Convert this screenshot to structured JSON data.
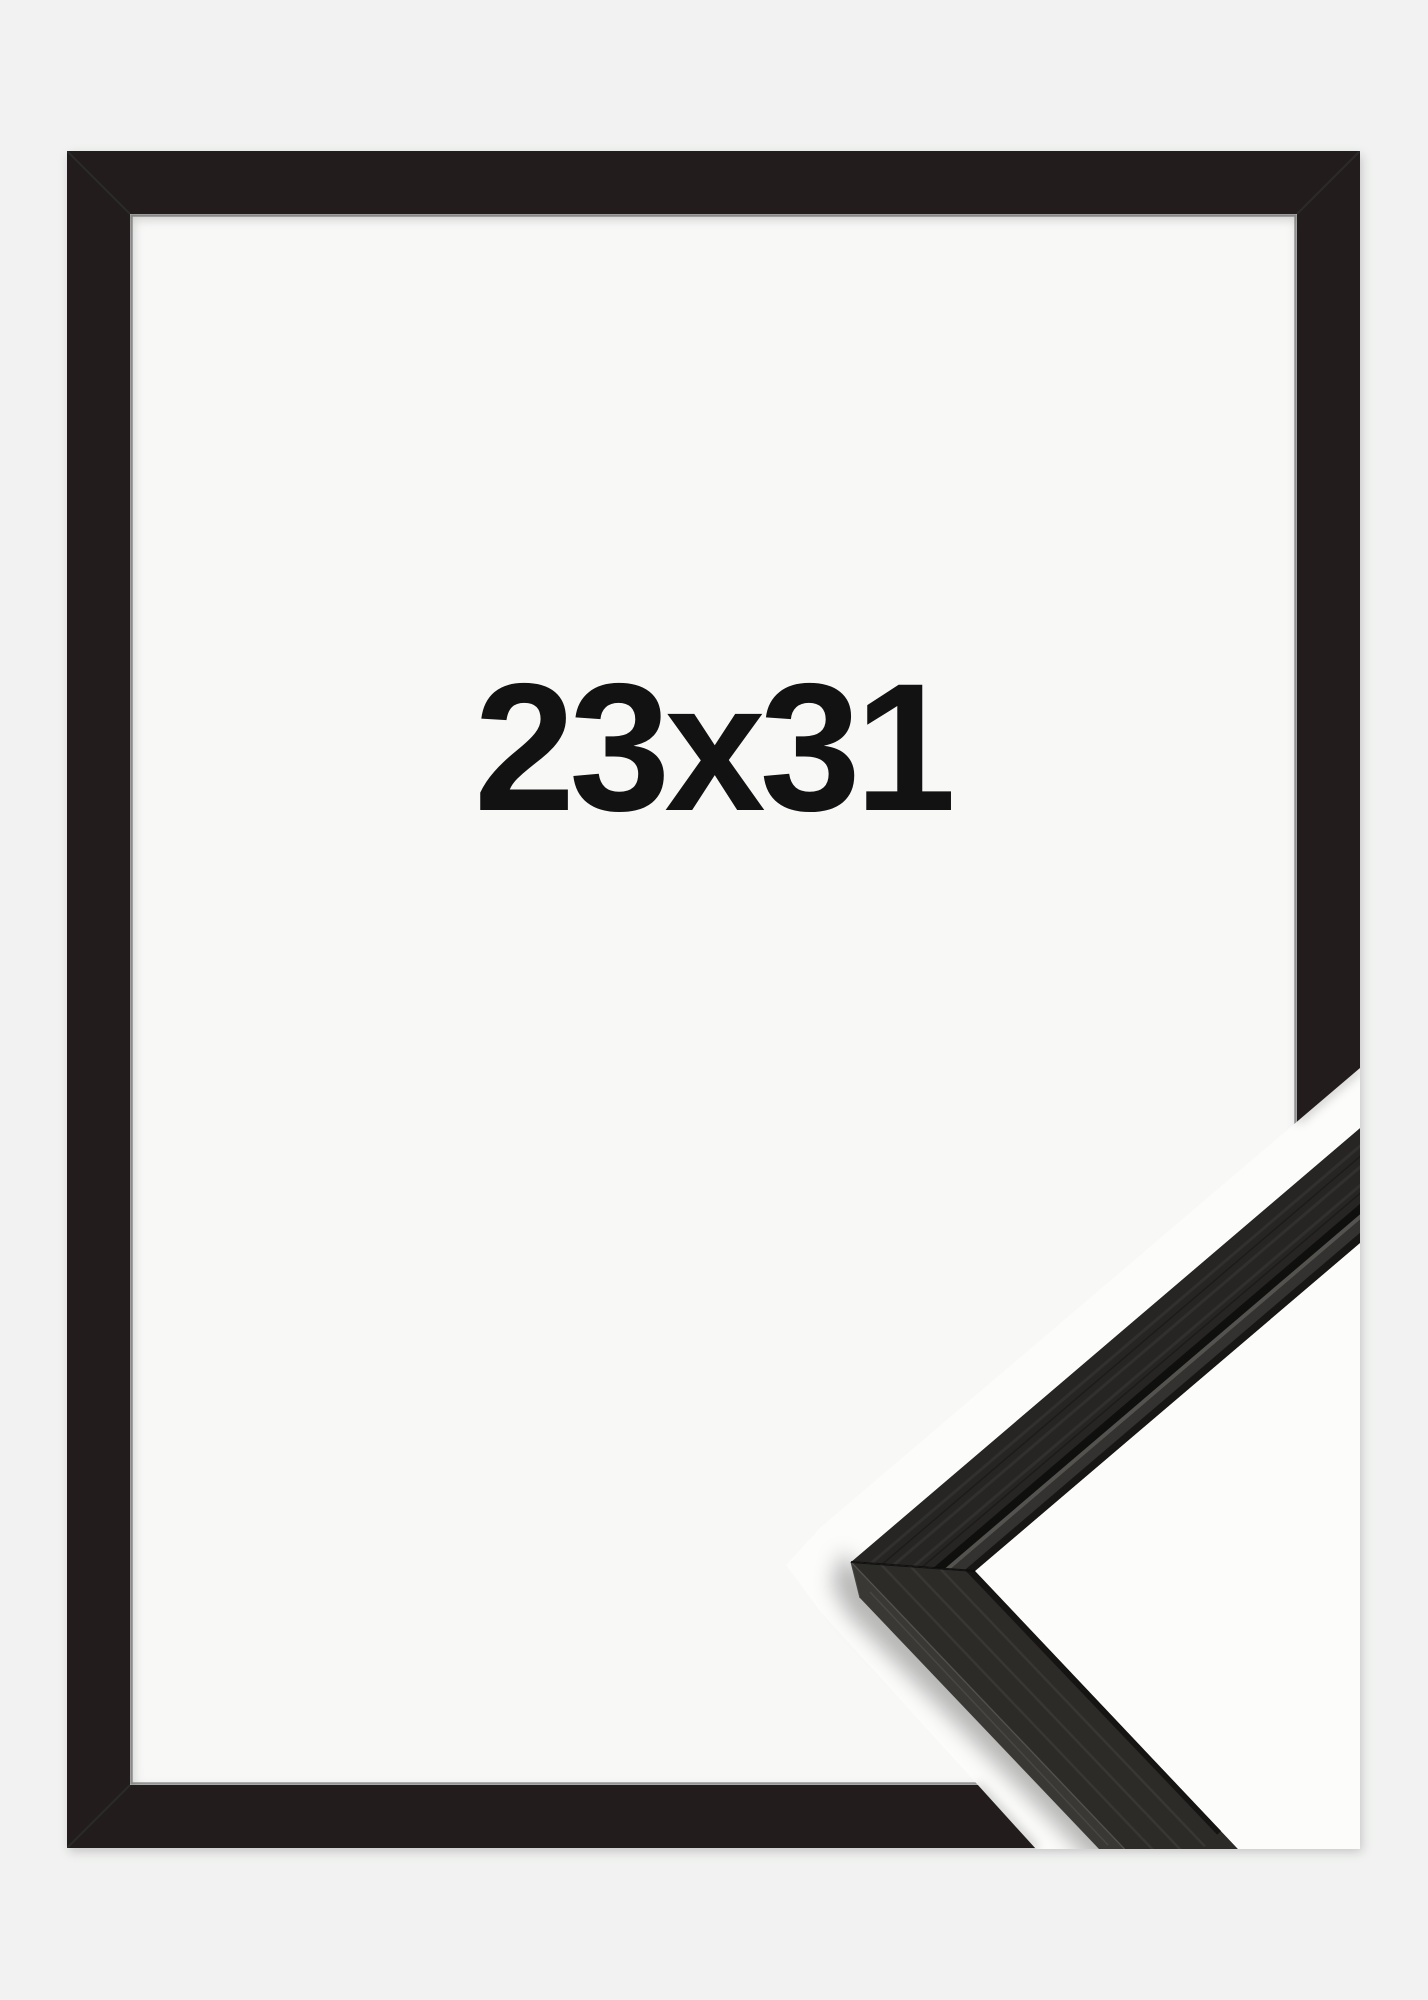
{
  "image": {
    "alt": "Black picture frame product photo with diagonal close-up of the frame corner profile",
    "size_label": "23x31"
  },
  "colors": {
    "background": "#f1f2f1",
    "inner_backdrop": "#f8f8f7",
    "sample_background": "#fcfcfb",
    "frame_black": "#201f1e",
    "frame_inner_lip": "#3a3937",
    "molding_face": "#262523",
    "molding_lower_face": "#2c2b28",
    "molding_side": "#3a3835",
    "label_text": "#121212"
  }
}
